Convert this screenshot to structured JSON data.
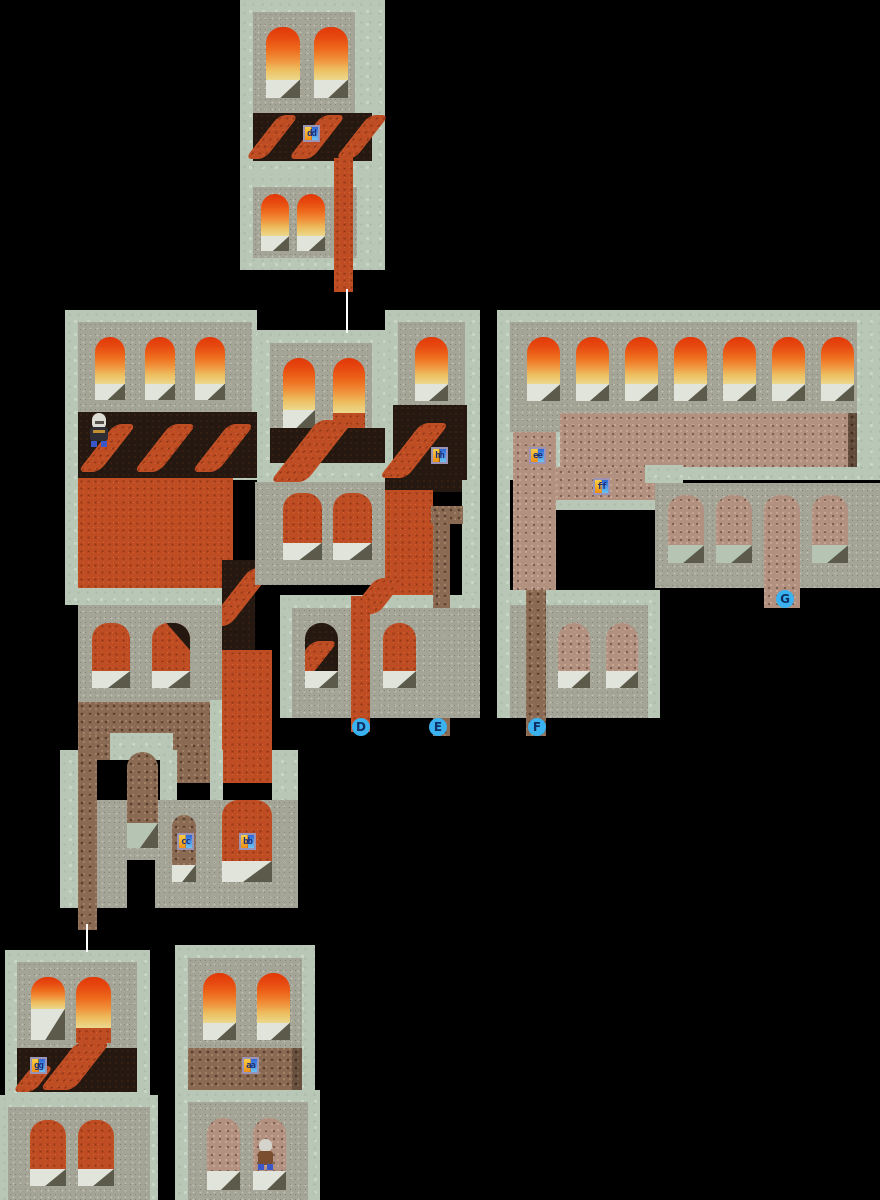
{
  "map": {
    "type": "dungeon-map-overview",
    "background": "#000000",
    "palette": {
      "border_sage": "#b9c7b7",
      "stone_wall": "#a4a497",
      "dark_floor": "#241810",
      "lava": "#bf4d24",
      "brick_brown": "#8a6a52",
      "brick_pink": "#b29181",
      "window_fire_top": "#e23708",
      "window_fire_mid": "#f0923c",
      "window_fire_low": "#ecd98d",
      "window_sill": "#e0e4da",
      "fold_shadow": "#5c5a4b",
      "marker_fill": "#39b2ef",
      "marker_text": "#0f3066",
      "tag_left_top": "#f9ce44",
      "tag_left_bottom": "#ee8f14",
      "tag_right_top": "#2e66d8",
      "tag_right_bottom": "#6cc4f4",
      "connector_line": "#ffffff"
    },
    "door_tags": [
      {
        "label": "dd"
      },
      {
        "label": "hh"
      },
      {
        "label": "ee"
      },
      {
        "label": "ff"
      },
      {
        "label": "cc"
      },
      {
        "label": "bb"
      },
      {
        "label": "gg"
      },
      {
        "label": "aa"
      }
    ],
    "exit_pins": [
      {
        "label": "D"
      },
      {
        "label": "E"
      },
      {
        "label": "F"
      },
      {
        "label": "G"
      }
    ],
    "npcs": [
      {
        "name": "hooded skeleton"
      },
      {
        "name": "villager (back view)"
      }
    ]
  }
}
